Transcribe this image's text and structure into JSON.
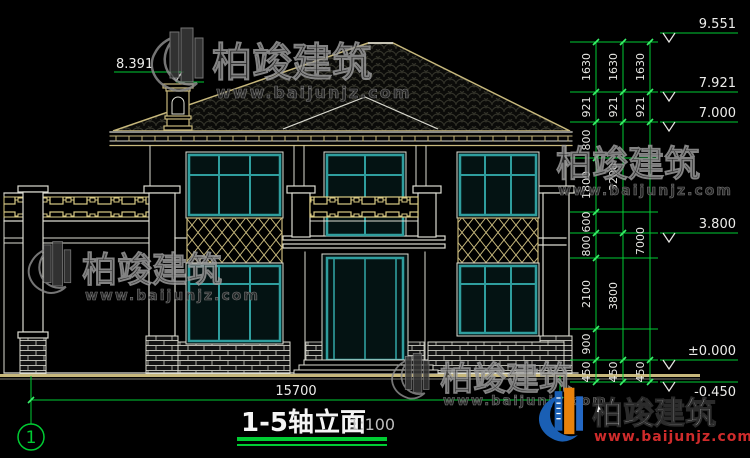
{
  "drawing": {
    "title": "1-5轴立面",
    "scale": "1:100",
    "axis_label": "1",
    "bottom_dimension": "15700"
  },
  "elevations": {
    "left": "8.391",
    "right": [
      "9.551",
      "7.921",
      "7.000",
      "3.800",
      "±0.000",
      "-0.450"
    ]
  },
  "dim_chains": {
    "col1": [
      "1630",
      "921",
      "800",
      "1800",
      "600",
      "800",
      "2100",
      "900",
      "450"
    ],
    "col2": [
      "1630",
      "921",
      "3200",
      "3800",
      "450"
    ],
    "col3": [
      "1630",
      "921",
      "7000",
      "450"
    ]
  },
  "watermark": {
    "brand": "柏竣建筑",
    "url": "www.baijunjz.com"
  },
  "colors": {
    "background": "#000000",
    "annotation_green": "#00cc33",
    "wall_line": "#dcdcd2",
    "trim_tan": "#c7b87c",
    "window_teal": "#2f9e9e",
    "watermark_gray": "#9a9a9a",
    "logo_blue": "#1a5fb4",
    "logo_orange": "#e8820c",
    "url_red": "#ce2b2b"
  }
}
